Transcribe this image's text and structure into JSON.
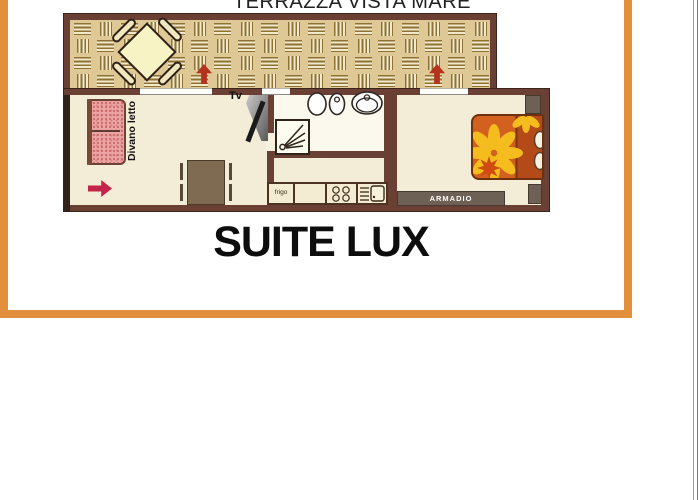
{
  "header": {
    "title": "TERRAZZA VISTA MARE"
  },
  "caption": {
    "text": "SUITE LUX"
  },
  "plan": {
    "labels": {
      "sofa_bed": "Divano letto",
      "tv": "Tv",
      "fridge": "frigo",
      "wardrobe": "ARMADIO"
    },
    "colors": {
      "frame_orange": "#e2903b",
      "wall_brown": "#6a4034",
      "terrace_tan": "#ddc896",
      "weave_dark": "#8d7233",
      "floor_cream": "#f3edd7",
      "bath_white": "#fbf9ee",
      "sofa_pink": "#eca3a3",
      "bed_orange": "#d2601f",
      "bed_pillow_rust": "#b54a19",
      "flower_yellow": "#f4bc1c",
      "flower_core_red": "#cf4b10",
      "furniture_gray": "#6d6155",
      "entry_arrow_red": "#c5244a",
      "door_arrow_red": "#b5321f"
    }
  }
}
